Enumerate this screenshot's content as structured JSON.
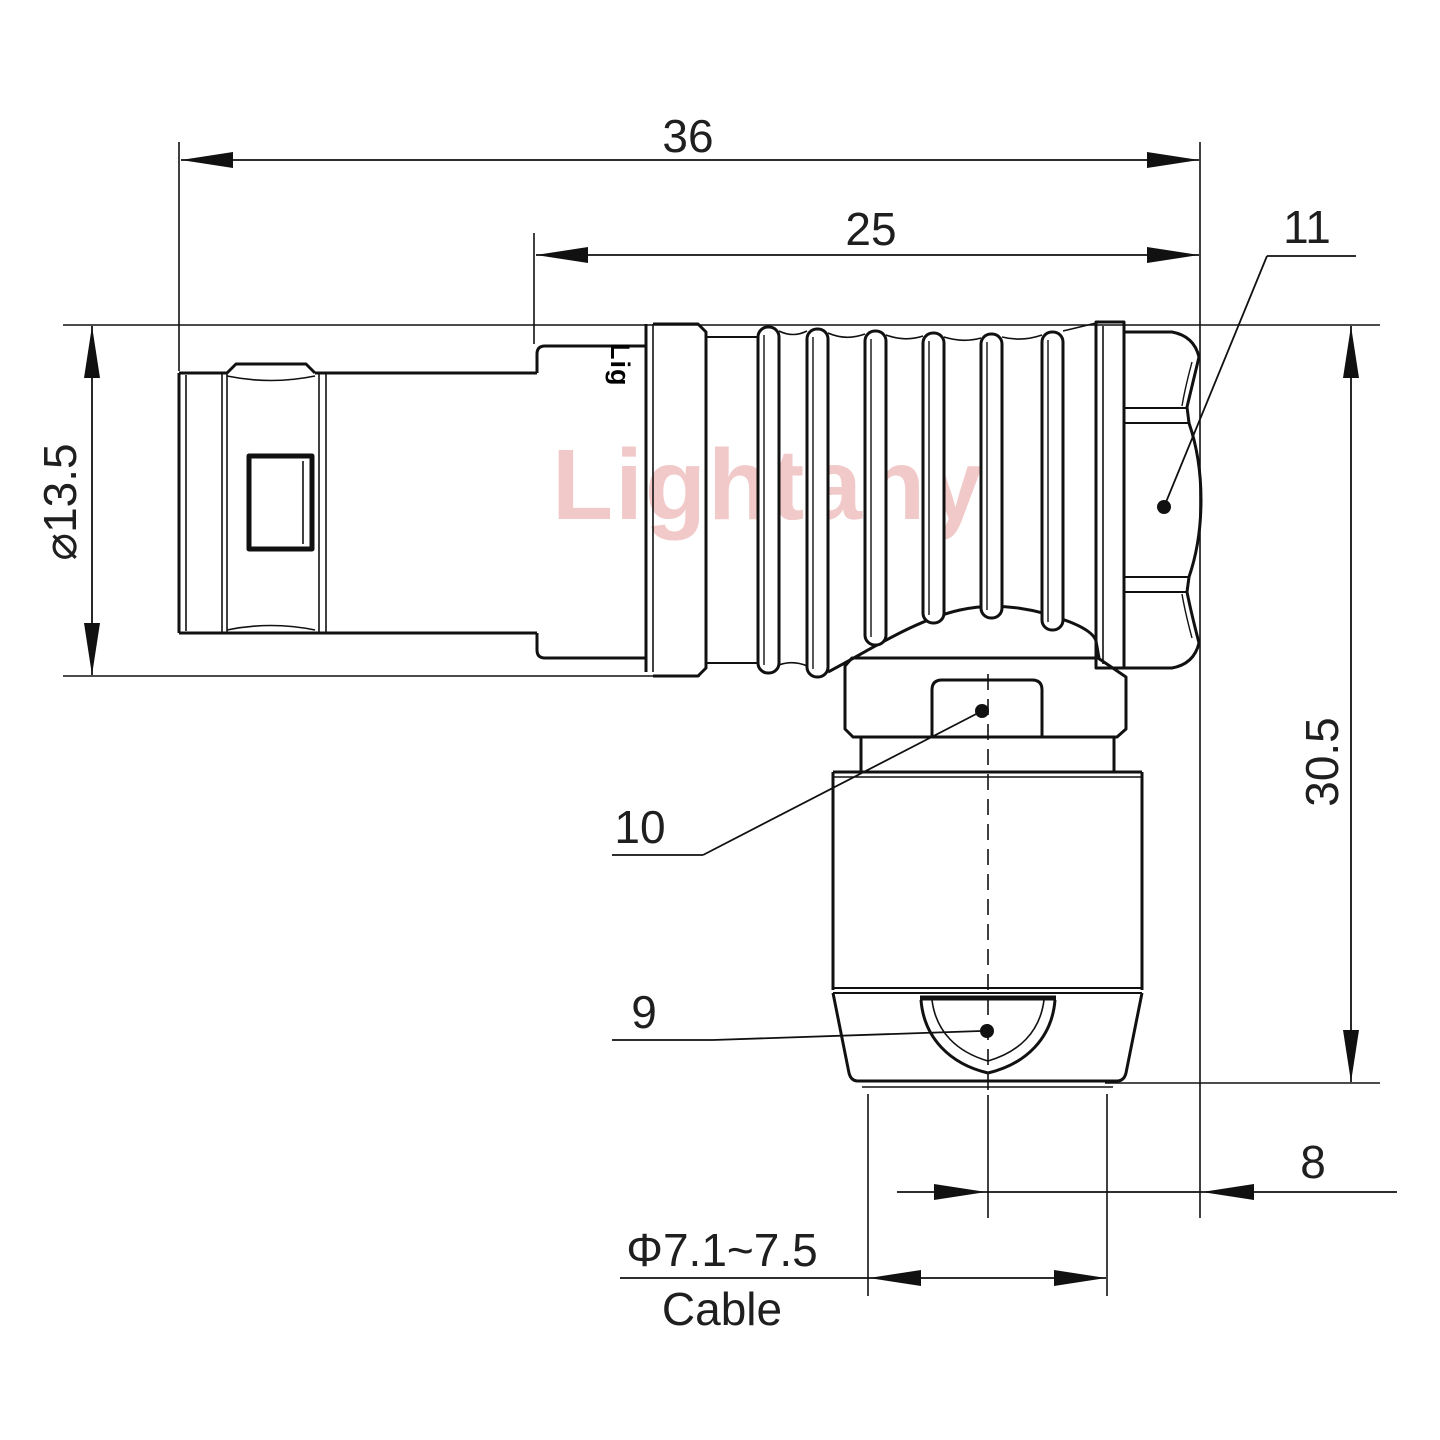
{
  "colors": {
    "line": "#111111",
    "text": "#1f1f1f",
    "watermark": "#f2c9c9",
    "background": "#ffffff"
  },
  "watermark": {
    "text": "Lightany"
  },
  "body_markings": {
    "logo": "Lig"
  },
  "dimensions": {
    "overall_length": "36",
    "body_length": "25",
    "front_diameter": "⌀13.5",
    "overall_height": "30.5",
    "axis_offset": "8",
    "cable_range": "Φ7.1~7.5",
    "cable_label": "Cable"
  },
  "part_labels": {
    "cable_nut": "9",
    "back_nut": "10",
    "end_cap": "11"
  }
}
